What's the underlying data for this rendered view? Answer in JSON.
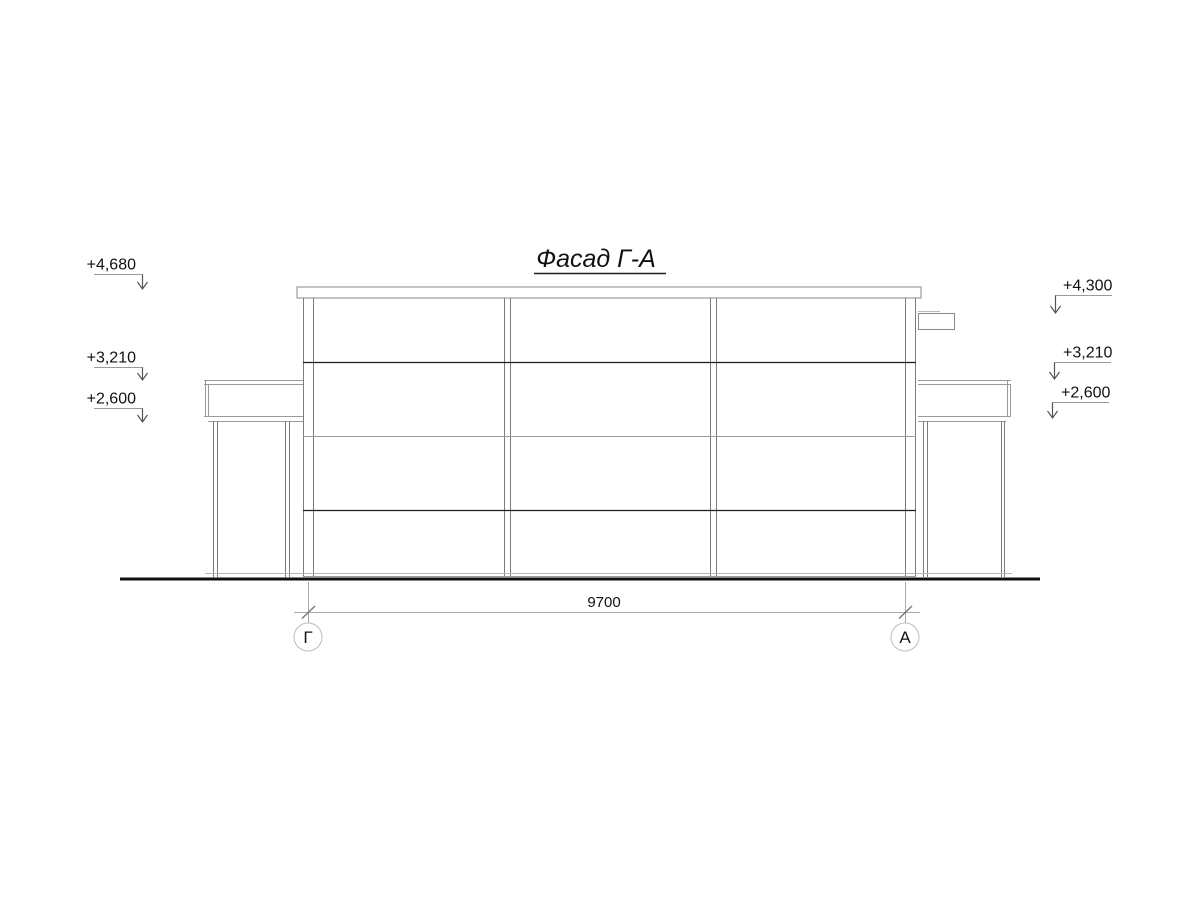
{
  "drawing": {
    "title": "Фасад Г-А",
    "dimension_bottom": "9700",
    "axis_left": "Г",
    "axis_right": "А",
    "elevations_left": [
      "+4,680",
      "+3,210",
      "+2,600"
    ],
    "elevations_right": [
      "+4,300",
      "+3,210",
      "+2,600"
    ],
    "colors": {
      "background": "#ffffff",
      "line_dark": "#1c1c1c",
      "line_gray": "#7d7d7d",
      "line_light": "#b8b8b8",
      "ground": "#111111",
      "text": "#111111"
    }
  }
}
